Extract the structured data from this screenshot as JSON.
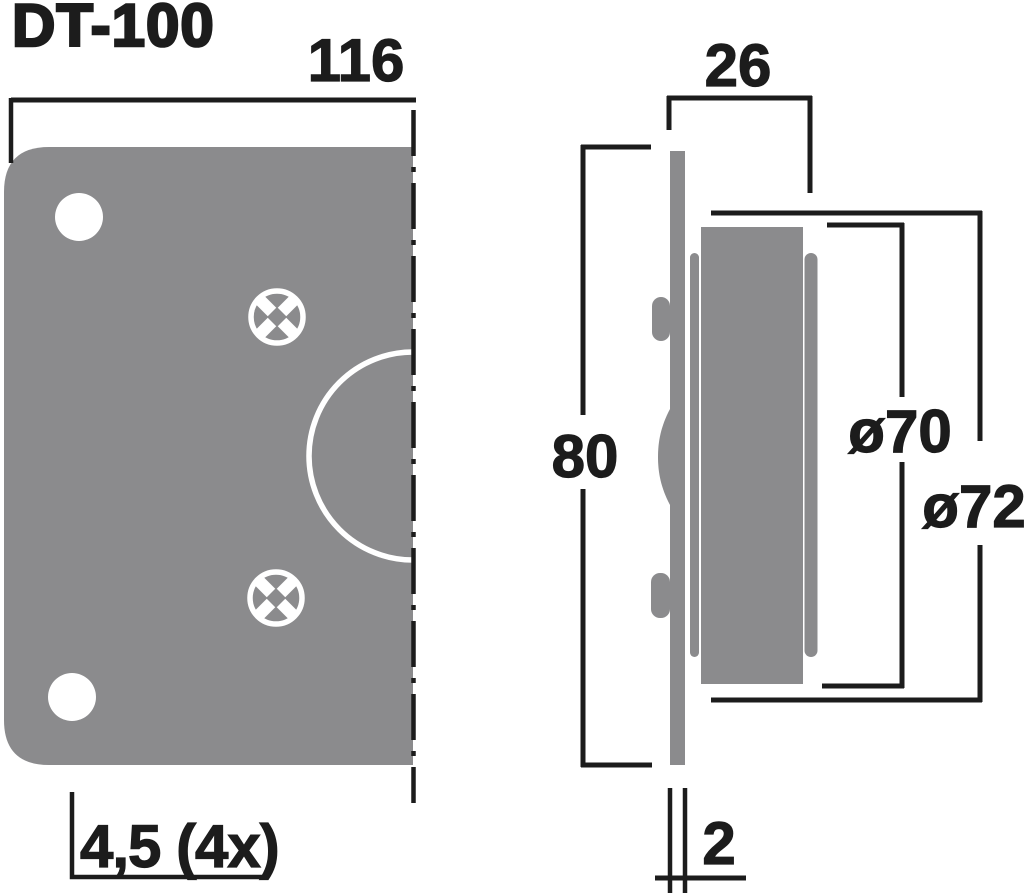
{
  "title": "DT-100",
  "front_view": {
    "width": "116",
    "mounting_hole": "4,5 (4x)"
  },
  "side_view": {
    "depth": "26",
    "height": "80",
    "magnet_diameter": "ø70",
    "rear_diameter": "ø72",
    "plate_thickness": "2"
  },
  "colors": {
    "body_gray": "#8b8b8d",
    "line_black": "#1c1c1c",
    "background": "#ffffff"
  }
}
